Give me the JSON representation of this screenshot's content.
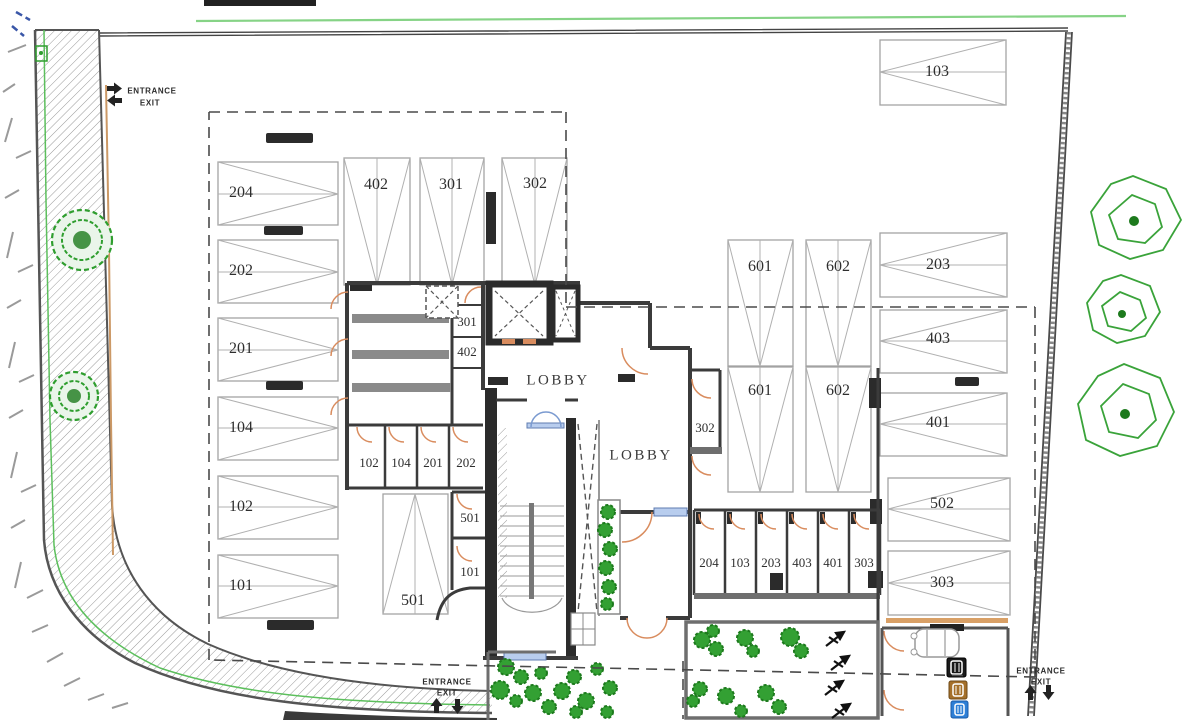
{
  "colors": {
    "background": "#ffffff",
    "wall_dark": "#3b3b3b",
    "wall_gray": "#6e6e6e",
    "stall_line": "#a3a3a3",
    "door_orange": "#d98c5e",
    "window_blue": "#b8cdee",
    "window_blue_border": "#5f7cb0",
    "landscape_green": "#2f9e2f",
    "boundary_green": "#7cc47c",
    "dashed_boundary": "#4a4a4a",
    "curb_tan": "#cc9966",
    "bin_black": "#1a1a1a",
    "bin_brown": "#a5702a",
    "bin_blue": "#2e7fd6"
  },
  "entrances": {
    "top_left": {
      "entrance": "ENTRANCE",
      "exit": "EXIT"
    },
    "bottom_center": {
      "entrance": "ENTRANCE",
      "exit": "EXIT"
    },
    "bottom_right": {
      "entrance": "ENTRANCE",
      "exit": "EXIT"
    }
  },
  "lobbies": {
    "upper": "LOBBY",
    "lower": "LOBBY"
  },
  "parking_stalls": {
    "left_column": [
      "204",
      "202",
      "201",
      "104",
      "102",
      "101"
    ],
    "top_row": [
      "402",
      "301",
      "302"
    ],
    "top_right": [
      "103"
    ],
    "middle": [
      "501"
    ],
    "center_upper_pair": [
      "601",
      "602"
    ],
    "center_lower_pair": [
      "601",
      "602"
    ],
    "right_column": [
      "203",
      "403",
      "401",
      "502",
      "303"
    ]
  },
  "storage_rooms": {
    "upper_block": [
      "301",
      "402"
    ],
    "middle_row": [
      "102",
      "104",
      "201",
      "202"
    ],
    "stair_side": [
      "501",
      "101"
    ],
    "corridor": [
      "302"
    ],
    "lower_row": [
      "204",
      "103",
      "203",
      "403",
      "401",
      "303"
    ]
  },
  "icons": {
    "entrance_in_icon": "arrow-right",
    "entrance_out_icon": "arrow-left",
    "ramp_up_icon": "arrow-up",
    "ramp_down_icon": "arrow-down",
    "waste_bins": [
      "general-waste-bin",
      "organic-waste-bin",
      "recycling-bin"
    ]
  }
}
